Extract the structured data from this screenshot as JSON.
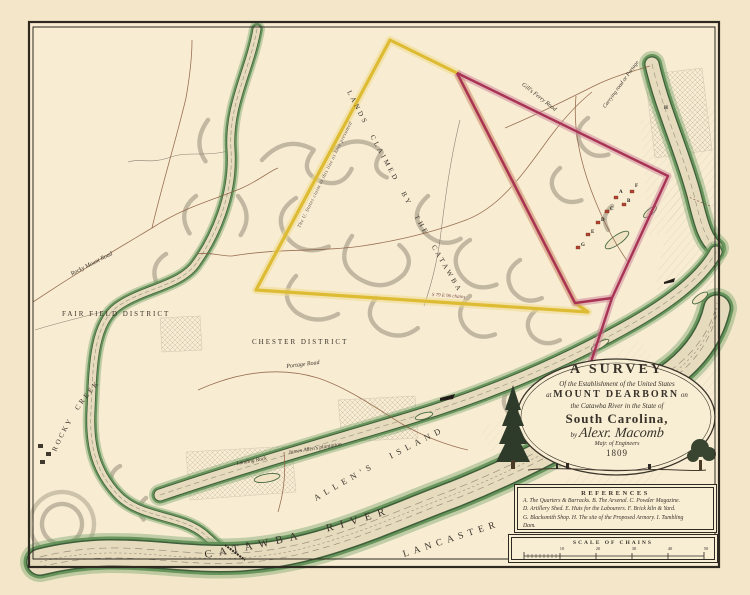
{
  "labels": {
    "fair_field_district": "FAIR FIELD DISTRICT",
    "chester_district": "CHESTER DISTRICT",
    "lancaster_county": "LANCASTER COUNTY",
    "allens_island": "ALLEN'S  ISLAND",
    "catawba_river": "CATAWBA   RIVER",
    "rocky_creek": "ROCKY CREEK",
    "rocky_mount_road": "Rocky Mount Road",
    "portage_road": "Portage Road",
    "gills_ferry_road": "Gill's Ferry Road",
    "carrying_road": "Carrying road or Portage",
    "landing_rock": "Landing Rock",
    "james_allens_plantation": "James Allen's plantation",
    "lands_claimed": "LANDS CLAIMED BY THE CATAWBA INDIANS",
    "us_claim_note": "The U. States claim to this line as here presumed",
    "bearing_south": "S 79 E 96 chains"
  },
  "cartouche": {
    "line1": "A SURVEY",
    "line2": "Of the Establishment of the United States",
    "line3_prefix": "at",
    "line3_main": "MOUNT DEARBORN",
    "line3_suffix": "on",
    "line4": "the Catawba River in the State of",
    "line5": "South Carolina,",
    "line6_by": "by",
    "line6_name": "Alexr. Macomb",
    "line7": "Majr. of Engineers",
    "line8": "1809"
  },
  "references": {
    "heading": "REFERENCES",
    "line1": "A. The Quarters & Barracks.  B. The Arsenal.  C. Powder Magazine.",
    "line2": "D. Artillery Shed.  E. Huts for the Labourers.  F. Brick kiln & Yard.",
    "line3": "G. Blacksmith Shop.  H. The site of the Proposed Armory.  I. Tumbling",
    "line4": "Dam."
  },
  "scale_bar": {
    "label": "SCALE OF CHAINS",
    "ticks": [
      "10",
      "20",
      "30",
      "40",
      "50"
    ]
  },
  "site_letters": [
    "A",
    "B",
    "C",
    "D",
    "E",
    "F",
    "G",
    "H",
    "I"
  ],
  "colors": {
    "paper": "#f4e7c9",
    "survey_yellow": "#ddbb33",
    "survey_red": "#a83355",
    "river_green": "#5e8f54",
    "ink": "#3a332a"
  }
}
